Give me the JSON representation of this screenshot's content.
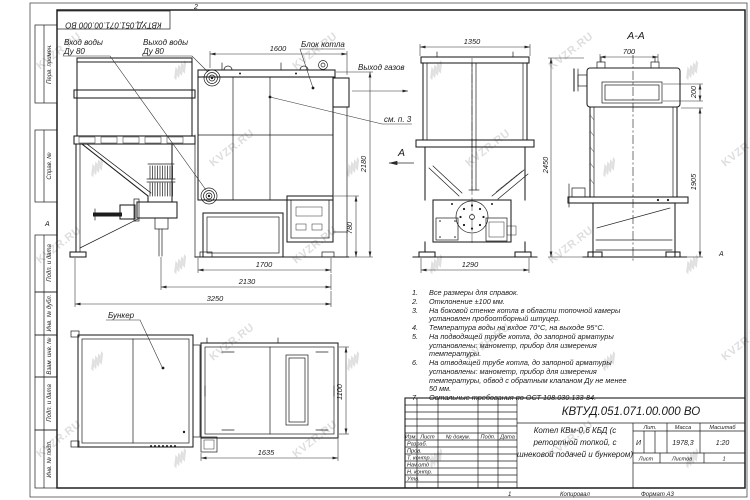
{
  "doc_code": "КВТУД.051.071.00.000 ВО",
  "watermark": {
    "text": "KVZR.RU"
  },
  "frame": {
    "left_labels": [
      "Перв. примен.",
      "Справ. №",
      "Подп. и дата",
      "Инв. № дубл.",
      "Взам. инв. №",
      "Подп. и дата",
      "Инв. № подл."
    ],
    "zone_top": "2",
    "zone_bottom": "1",
    "zone_left": "А",
    "zone_right": "А",
    "copied": "Копировал",
    "format": "Формат А3"
  },
  "callouts": {
    "water_in_1": "Вход воды",
    "water_in_2": "Ду 80",
    "water_out_1": "Выход воды",
    "water_out_2": "Ду 80",
    "boiler_block": "Блок котла",
    "gas_out": "Выход газов",
    "see_note": "см. п. 3",
    "bunker": "Бункер",
    "section_title": "А-А",
    "view_arrow": "А"
  },
  "dims": {
    "front_top": "1600",
    "front_h": "2180",
    "front_door": "780",
    "front_w1": "1700",
    "front_w2": "2130",
    "front_w3": "3250",
    "side_top": "1350",
    "side_bottom": "1290",
    "sec_top": "700",
    "sec_h": "2450",
    "sec_right": "1905",
    "sec_small": "200",
    "plan_w": "1635",
    "plan_h": "1100"
  },
  "notes": [
    {
      "num": "1.",
      "text": "Все размеры для справок."
    },
    {
      "num": "2.",
      "text": "Отклонение ±100 мм."
    },
    {
      "num": "3.",
      "text": "На боковой стенке котла в области топочной камеры установлен пробоотборный штуцер."
    },
    {
      "num": "4.",
      "text": "Температура воды на вхдое 70°С, на выходе 95°С."
    },
    {
      "num": "5.",
      "text": "На подводящей трубе котла, до запорной арматуры установлены: манометр, прибор для измерения температуры."
    },
    {
      "num": "6.",
      "text": "На отводящей трубе котла, до запорной арматуры установлены: манометр, прибор для измерения температуры, обвод с обратным клапаном Ду не менее 50 мм."
    },
    {
      "num": "7.",
      "text": "Остальные требования по ОСТ 108.030.133-84."
    }
  ],
  "title_block": {
    "designation": "КВТУД.051.071.00.000 ВО",
    "name_1": "Котел КВм-0,6 КБД (с",
    "name_2": "ретортной топкой, с",
    "name_3": "шнековой подачей и бункером)",
    "header_cols": [
      "Изм.",
      "Лист",
      "№ докум.",
      "Подп.",
      "Дата"
    ],
    "rows": [
      "Разраб.",
      "Пров.",
      "Т. контр.",
      "Нач.отд",
      "Н. контр.",
      "Утв."
    ],
    "lit_label": "Лит.",
    "lit_value": "И",
    "mass_label": "Масса",
    "mass_value": "1978,3",
    "scale_label": "Масштаб",
    "scale_value": "1:20",
    "sheet_label": "Лист",
    "sheets_label": "Листов",
    "sheets_value": "1"
  }
}
